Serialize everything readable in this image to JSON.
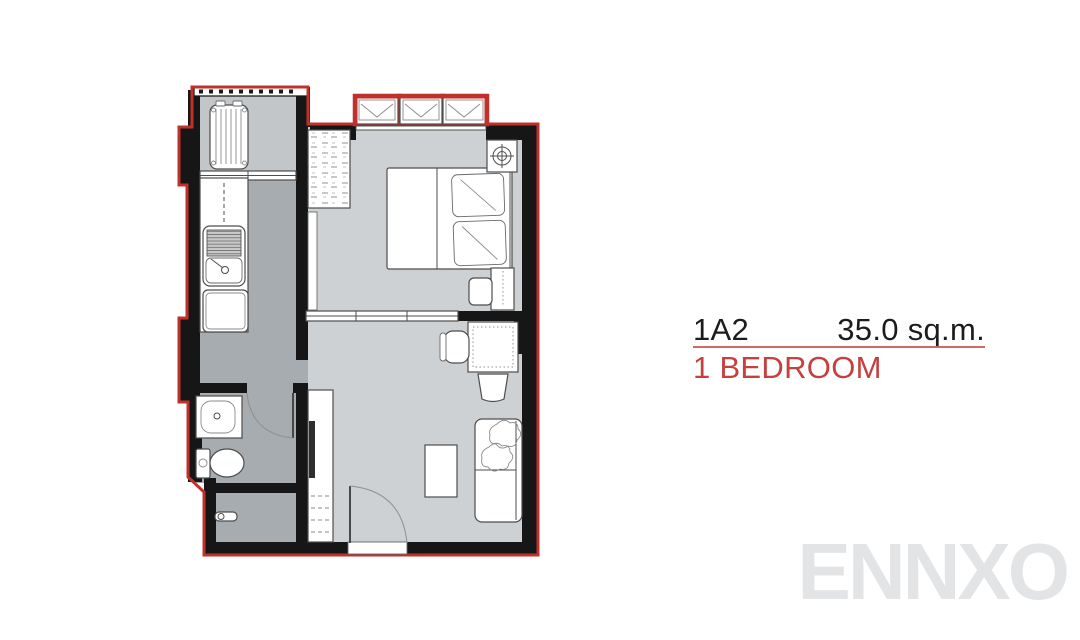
{
  "unit_info": {
    "unit_code": "1A2",
    "area": "35.0 sq.m.",
    "unit_type": "1 BEDROOM"
  },
  "watermark": {
    "text": "ENNXO"
  },
  "colors": {
    "wall": "#161616",
    "plan-outline": "#c0312b",
    "floor-light": "#cdd1d4",
    "floor-mid": "#c2c6c9",
    "floor-dark": "#a7acb0",
    "accent-red": "#c5403f",
    "divider-red": "#cc6b66",
    "watermark-gray": "#e3e4e6",
    "text-dark": "#1c1c1c"
  },
  "floorplan": {
    "rooms": [
      "balcony",
      "kitchen",
      "bathroom",
      "foyer",
      "bedroom",
      "living-area"
    ],
    "features": [
      "ac-condenser-unit",
      "balcony-sliding-door",
      "kitchen-counter",
      "kitchen-sink",
      "under-counter-appliance",
      "wardrobe",
      "double-bed",
      "pillows",
      "ceiling-fan-symbol",
      "nightstand",
      "bedside-stool",
      "sliding-partition",
      "desk",
      "desk-chair",
      "stool",
      "sofa",
      "sofa-cushions",
      "coffee-table",
      "tv-console",
      "tv",
      "washbasin",
      "toilet",
      "bathroom-door",
      "entrance-door",
      "door-handle",
      "awning-windows"
    ]
  }
}
